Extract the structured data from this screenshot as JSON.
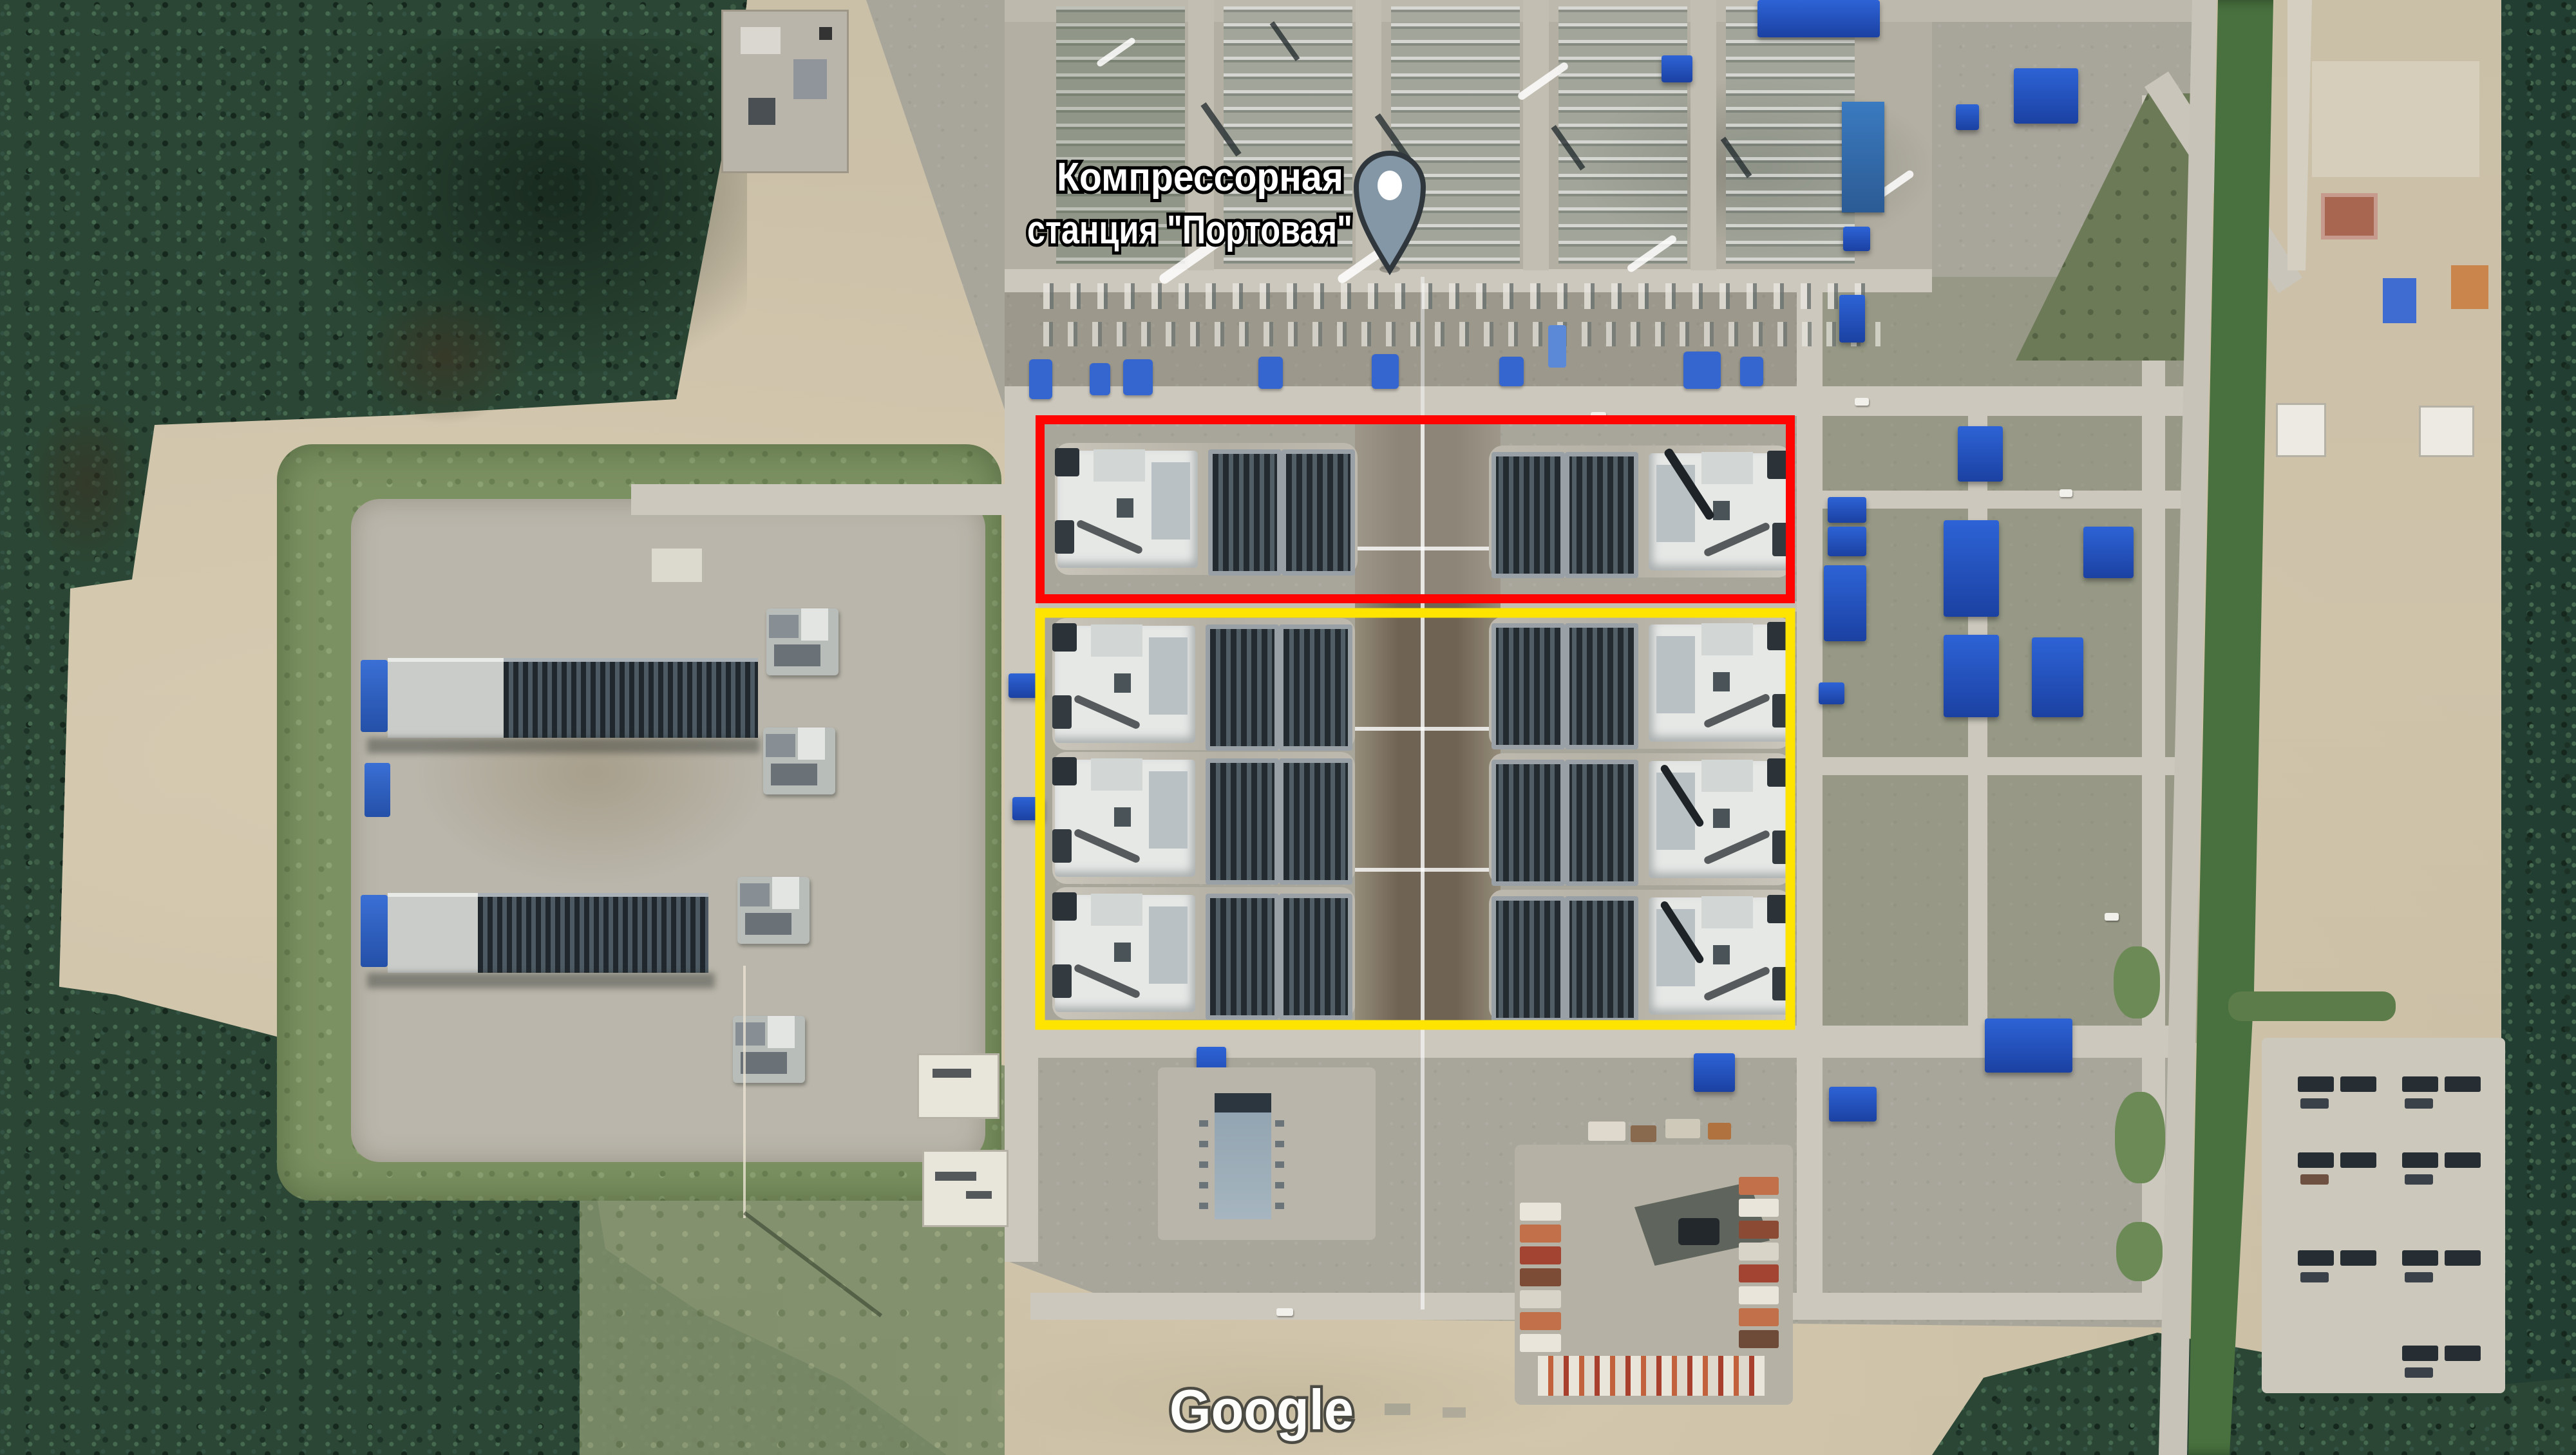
{
  "place_label": {
    "line1": "Компрессорная",
    "line2": "станция \"Портовая\"",
    "marker_icon": "map-pin-icon",
    "marker_fill": "#8497a7",
    "marker_outline": "#30373c"
  },
  "watermark": {
    "text": "Google"
  },
  "annotations": {
    "red_box": {
      "color": "#ff0400",
      "role": "highlight-upper-compressor-row"
    },
    "yellow_box": {
      "color": "#ffe400",
      "role": "highlight-lower-compressor-block"
    }
  }
}
